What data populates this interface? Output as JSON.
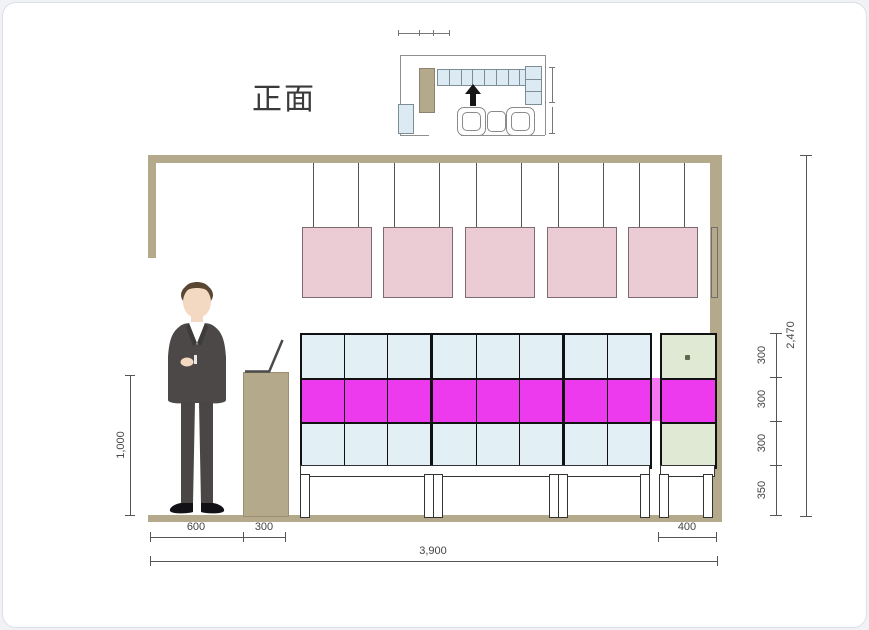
{
  "title": "正面",
  "floor_plan": {
    "top_shelf_cells": 8,
    "right_stack_cells": 3,
    "north_arrow": "up"
  },
  "elevation": {
    "pendant_count": 5,
    "shelf_columns": 8,
    "shelf_rows": 3,
    "side_cabinet_rows": 3
  },
  "dimensions": {
    "stand_height": "1,000",
    "person_zone_width": "600",
    "counter_width": "300",
    "overall_width": "3,900",
    "side_cabinet_width": "400",
    "shelf_row_1": "300",
    "shelf_row_2": "300",
    "shelf_row_3": "300",
    "base_height": "350",
    "overall_height": "2,470"
  },
  "colors": {
    "beige": "#b5a98c",
    "pendant_pink": "#ecccd4",
    "cell_blue": "#e2f0f6",
    "cell_magenta": "#ee3aee",
    "magenta_pass": "#f476f2",
    "cell_green": "#dfe9d3",
    "dimension_line": "#555555"
  }
}
